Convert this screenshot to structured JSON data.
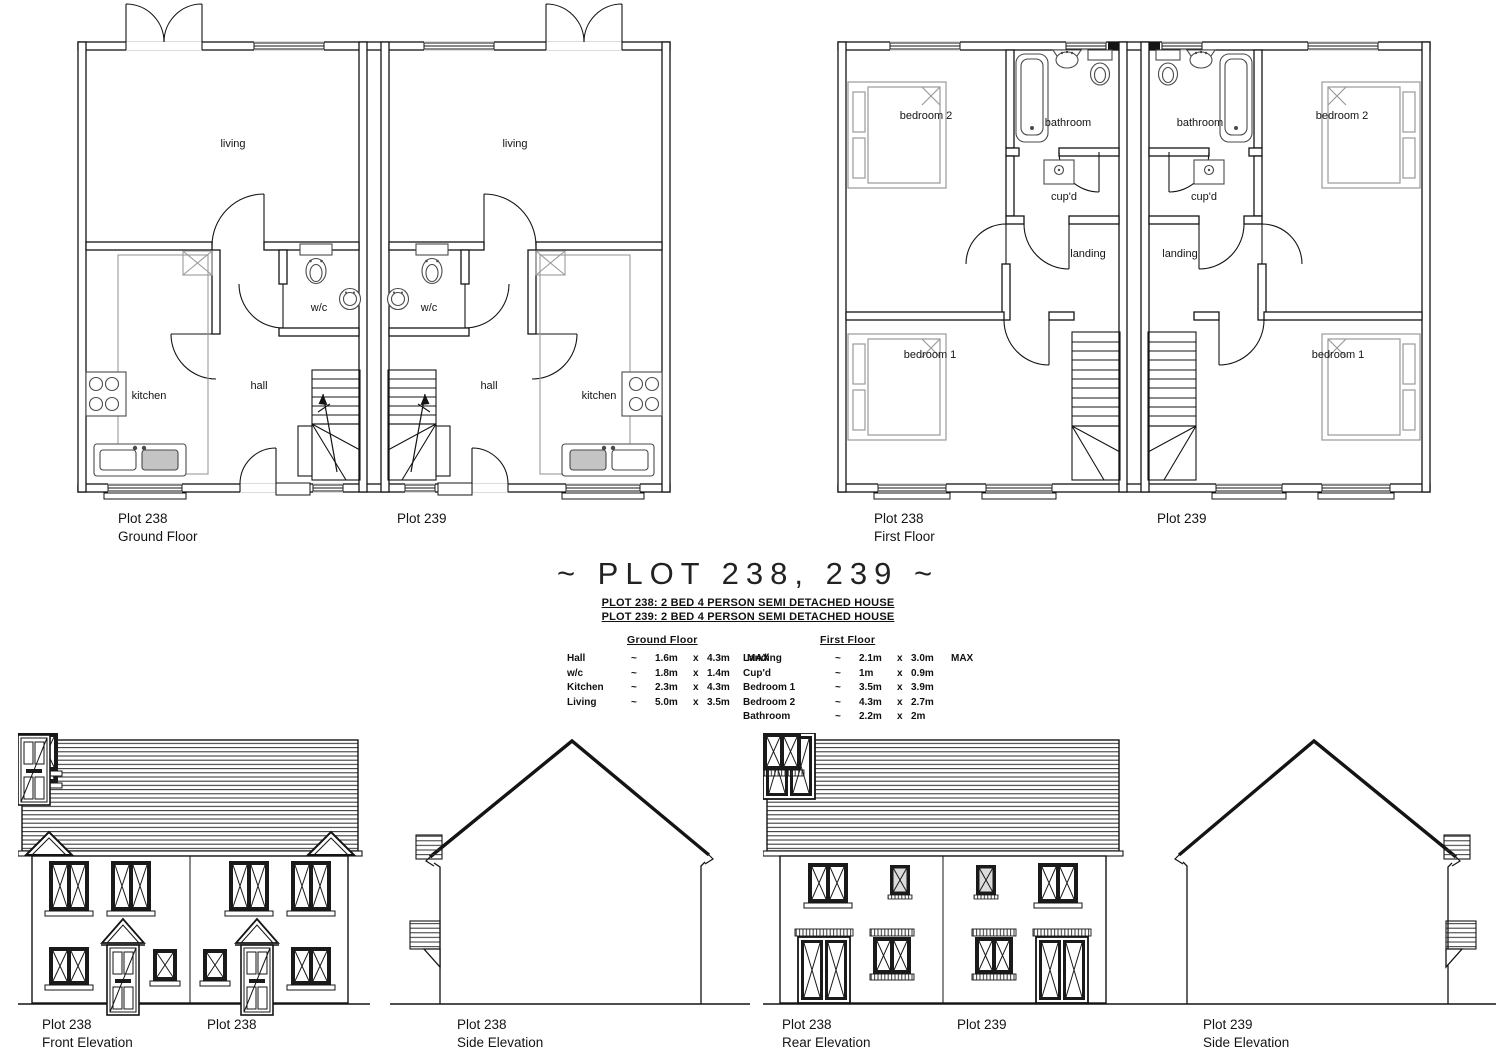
{
  "title": {
    "text": "~  PLOT 238, 239  ~"
  },
  "subtitle": {
    "line1": "PLOT 238: 2 BED 4 PERSON SEMI DETACHED HOUSE",
    "line2": "PLOT 239: 2 BED 4 PERSON SEMI DETACHED HOUSE"
  },
  "spec": {
    "ground": {
      "header": "Ground Floor",
      "rows": [
        {
          "name": "Hall",
          "s": "~",
          "d1": "1.6m",
          "x": "x",
          "d2": "4.3m",
          "note": "MAX"
        },
        {
          "name": "w/c",
          "s": "~",
          "d1": "1.8m",
          "x": "x",
          "d2": "1.4m",
          "note": ""
        },
        {
          "name": "Kitchen",
          "s": "~",
          "d1": "2.3m",
          "x": "x",
          "d2": "4.3m",
          "note": ""
        },
        {
          "name": "Living",
          "s": "~",
          "d1": "5.0m",
          "x": "x",
          "d2": "3.5m",
          "note": ""
        }
      ]
    },
    "first": {
      "header": "First Floor",
      "rows": [
        {
          "name": "Landing",
          "s": "~",
          "d1": "2.1m",
          "x": "x",
          "d2": "3.0m",
          "note": "MAX"
        },
        {
          "name": "Cup'd",
          "s": "~",
          "d1": "1m",
          "x": "x",
          "d2": "0.9m",
          "note": ""
        },
        {
          "name": "Bedroom 1",
          "s": "~",
          "d1": "3.5m",
          "x": "x",
          "d2": "3.9m",
          "note": ""
        },
        {
          "name": "Bedroom 2",
          "s": "~",
          "d1": "4.3m",
          "x": "x",
          "d2": "2.7m",
          "note": ""
        },
        {
          "name": "Bathroom",
          "s": "~",
          "d1": "2.2m",
          "x": "x",
          "d2": "2m",
          "note": ""
        }
      ]
    }
  },
  "plans": {
    "ground": {
      "rooms": {
        "living": "living",
        "wc": "w/c",
        "hall": "hall",
        "kitchen": "kitchen"
      },
      "captions": {
        "left_plot": "Plot 238",
        "left_floor": "Ground Floor",
        "right_plot": "Plot 239"
      }
    },
    "first": {
      "rooms": {
        "bedroom2": "bedroom 2",
        "bathroom": "bathroom",
        "cupd": "cup'd",
        "landing": "landing",
        "bedroom1": "bedroom 1"
      },
      "captions": {
        "left_plot": "Plot 238",
        "left_floor": "First Floor",
        "right_plot": "Plot 239"
      }
    }
  },
  "elevations": {
    "front": {
      "plot": "Plot 238",
      "name": "Front Elevation",
      "plot2": "Plot 238"
    },
    "side238": {
      "plot": "Plot 238",
      "name": "Side Elevation"
    },
    "rear": {
      "plot": "Plot 238",
      "name": "Rear Elevation",
      "plot2": "Plot 239"
    },
    "side239": {
      "plot": "Plot 239",
      "name": "Side Elevation"
    }
  },
  "colors": {
    "line": "#141414",
    "light_line": "#9a9a9a",
    "paper": "#ffffff"
  }
}
